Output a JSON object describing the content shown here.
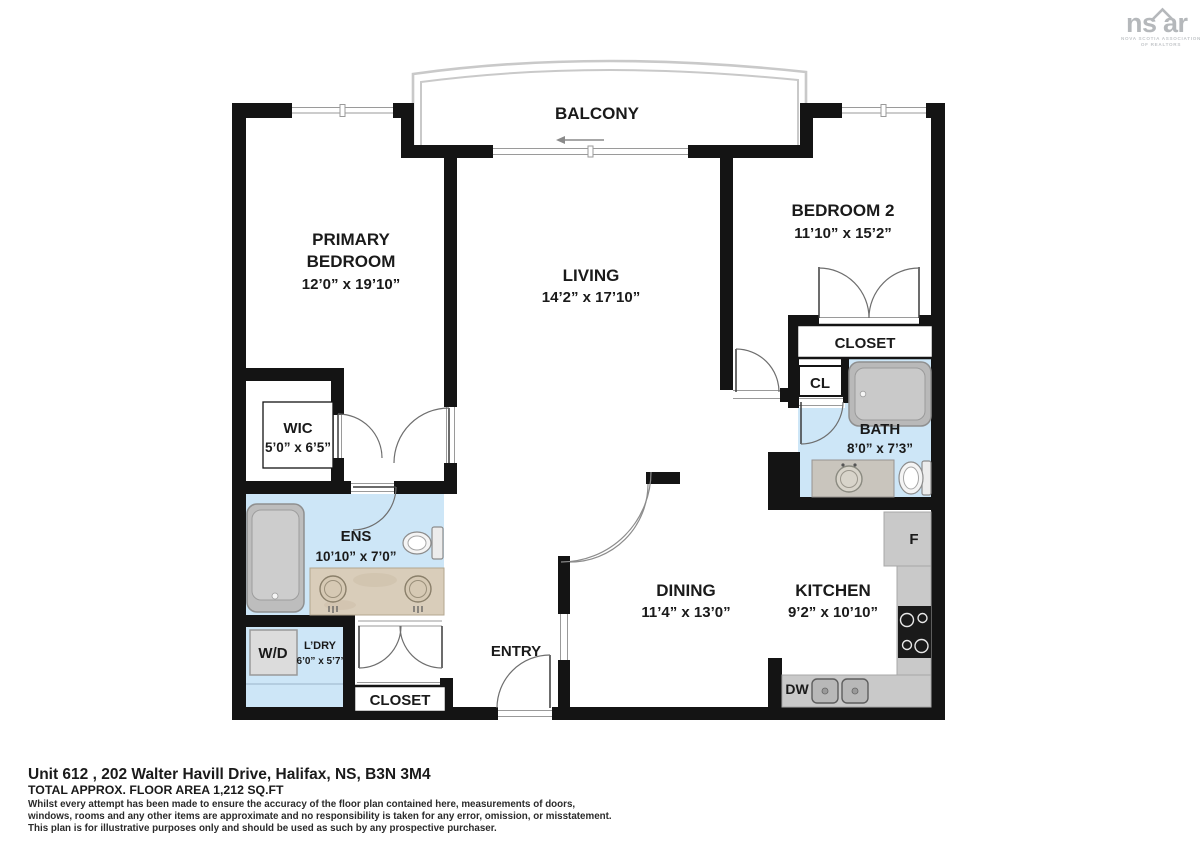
{
  "logo": {
    "part1": "ns",
    "part2": "ar",
    "subtitle1": "NOVA SCOTIA ASSOCIATION",
    "subtitle2": "OF REALTORS"
  },
  "rooms": {
    "balcony": {
      "label": "BALCONY"
    },
    "primary": {
      "line1": "PRIMARY",
      "line2": "BEDROOM",
      "dims": "12’0” x 19’10”"
    },
    "living": {
      "label": "LIVING",
      "dims": "14’2” x 17’10”"
    },
    "bedroom2": {
      "label": "BEDROOM 2",
      "dims": "11’10” x 15’2”"
    },
    "wic": {
      "label": "WIC",
      "dims": "5’0” x 6’5”"
    },
    "ens": {
      "label": "ENS",
      "dims": "10’10” x 7’0”"
    },
    "laundry": {
      "label": "L’DRY",
      "dims": "6’0” x 5’7”",
      "washer_dryer": "W/D"
    },
    "entry": {
      "label": "ENTRY"
    },
    "entry_closet": {
      "label": "CLOSET"
    },
    "dining": {
      "label": "DINING",
      "dims": "11’4” x 13’0”"
    },
    "kitchen": {
      "label": "KITCHEN",
      "dims": "9’2” x 10’10”",
      "fridge": "F",
      "dishwasher": "DW"
    },
    "bath": {
      "label": "BATH",
      "dims": "8’0” x 7’3”"
    },
    "closet_cl": {
      "label": "CL"
    },
    "bedroom2_closet": {
      "label": "CLOSET"
    }
  },
  "footer": {
    "address": "Unit 612 , 202 Walter Havill Drive, Halifax, NS, B3N 3M4",
    "area": "TOTAL APPROX. FLOOR AREA 1,212 SQ.FT",
    "disclaimer_line1": "Whilst every attempt has been made to ensure the accuracy of the floor plan contained here, measurements of doors,",
    "disclaimer_line2": "windows, rooms and any other items are approximate and no responsibility is taken for any error, omission, or misstatement.",
    "disclaimer_line3": "This plan is for illustrative purposes only and should be used as such by any prospective purchaser."
  },
  "colors": {
    "wall": "#141414",
    "wet_floor": "#cde6f7",
    "counter": "#c9c9c9",
    "logo_gray": "#b5b8bb"
  }
}
